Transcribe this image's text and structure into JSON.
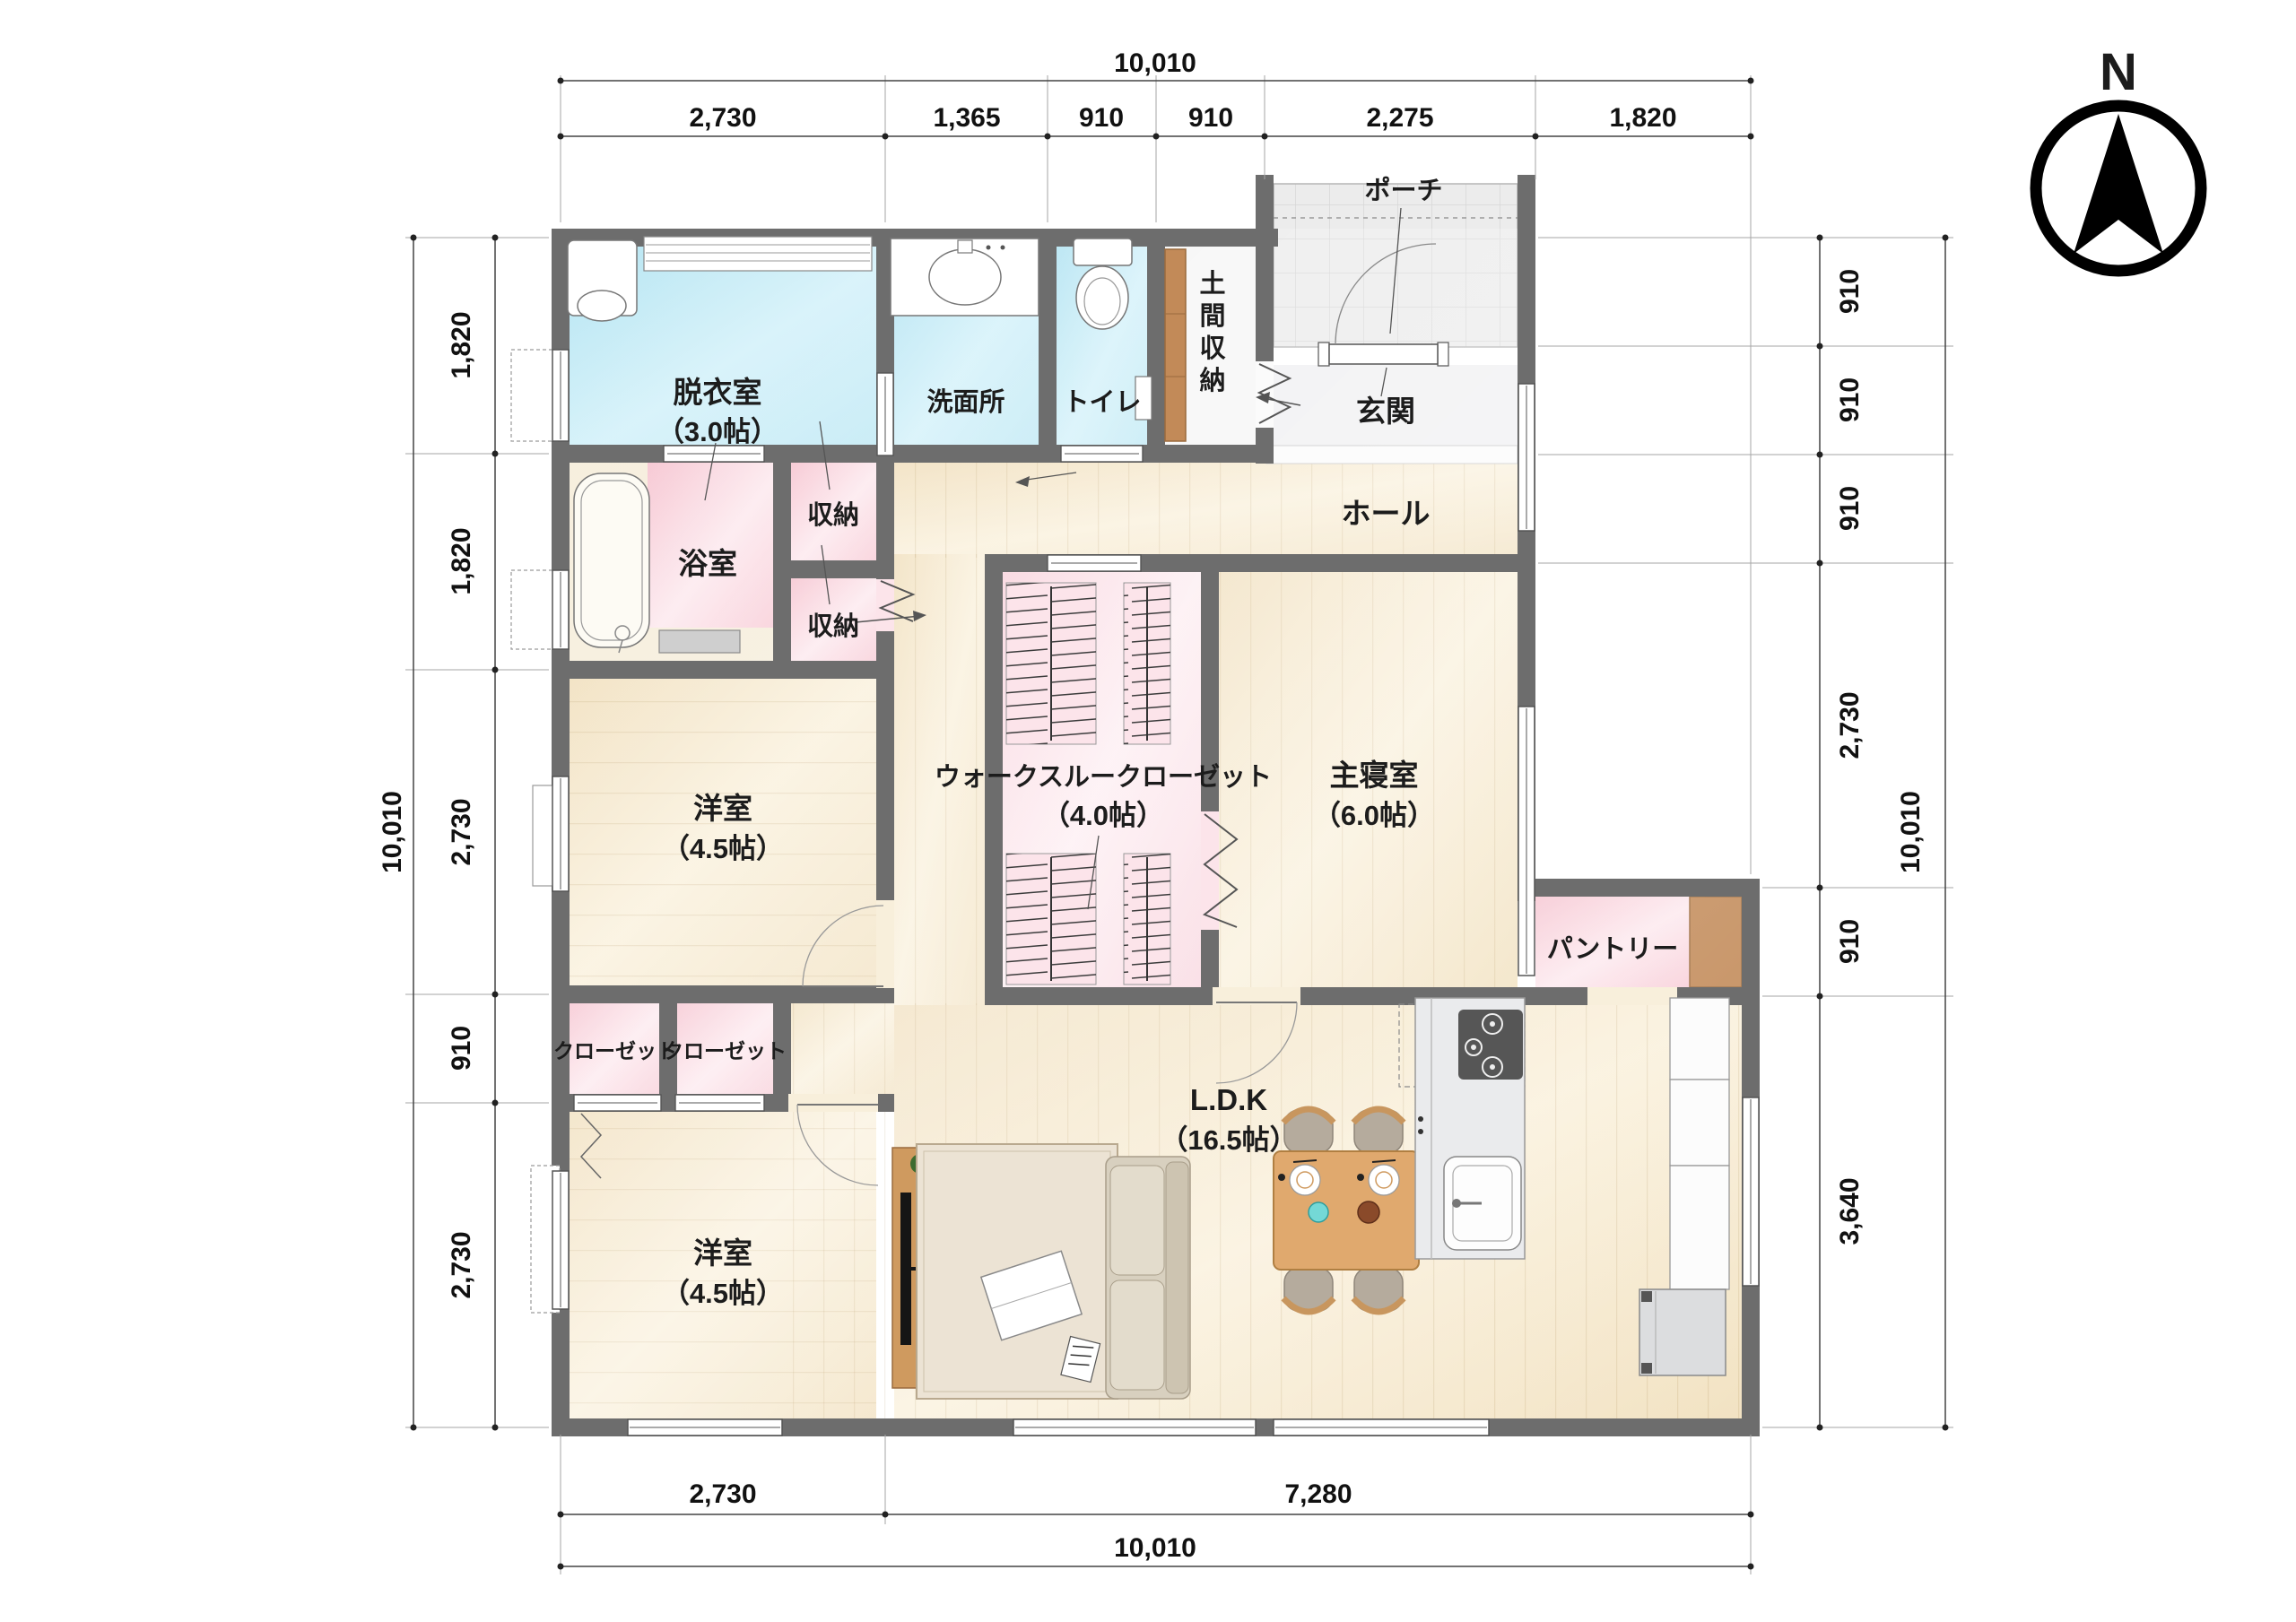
{
  "compass": {
    "label": "N"
  },
  "rooms": {
    "datsuishitsu": {
      "label": "脱衣室",
      "size": "（3.0帖）"
    },
    "senmenjo": {
      "label": "洗面所"
    },
    "toilet": {
      "label": "トイレ"
    },
    "doma": {
      "chars": [
        "土",
        "間",
        "収",
        "納"
      ]
    },
    "porch": {
      "label": "ポーチ"
    },
    "genkan": {
      "label": "玄関"
    },
    "hall": {
      "label": "ホール"
    },
    "bath": {
      "label": "浴室"
    },
    "storage1": {
      "label": "収納"
    },
    "storage2": {
      "label": "収納"
    },
    "bedroom1": {
      "label": "洋室",
      "size": "（4.5帖）"
    },
    "wtc": {
      "label": "ウォークスルークローゼット",
      "size": "（4.0帖）"
    },
    "master": {
      "label": "主寝室",
      "size": "（6.0帖）"
    },
    "pantry": {
      "label": "パントリー"
    },
    "closet1": {
      "label": "クローゼット"
    },
    "closet2": {
      "label": "クローゼット"
    },
    "ldk": {
      "label": "L.D.K",
      "size": "（16.5帖）"
    },
    "bedroom2": {
      "label": "洋室",
      "size": "（4.5帖）"
    }
  },
  "dimensions": {
    "top": {
      "total": "10,010",
      "segments": [
        "2,730",
        "1,365",
        "910",
        "910",
        "2,275",
        "1,820"
      ]
    },
    "left": {
      "total": "10,010",
      "segments": [
        "1,820",
        "1,820",
        "2,730",
        "910",
        "2,730"
      ]
    },
    "right": {
      "total": "10,010",
      "segments": [
        "910",
        "910",
        "910",
        "2,730",
        "910",
        "3,640"
      ]
    },
    "bottom": {
      "total": "10,010",
      "segments": [
        "2,730",
        "7,280"
      ]
    }
  },
  "colors": {
    "wall": "#6d6d6d",
    "wet_room": "#bfe8f4",
    "storage_pink": "#f7c9d3",
    "wood": "#f5e8cd",
    "accent_wood_shelf": "#c28a58"
  }
}
